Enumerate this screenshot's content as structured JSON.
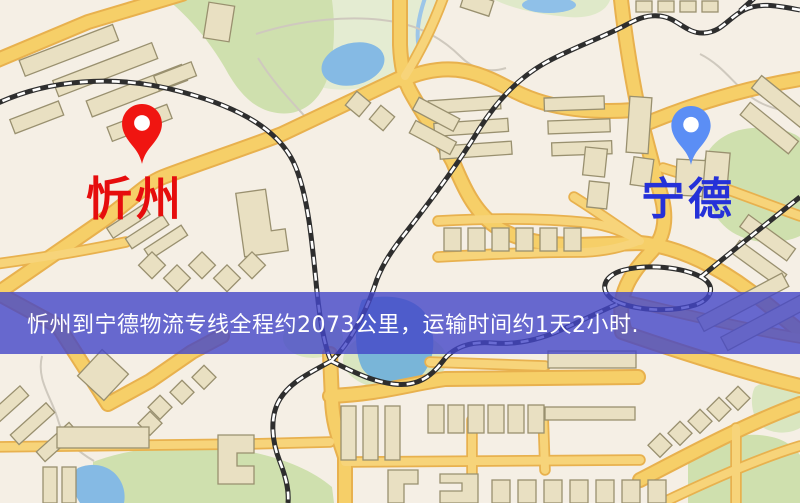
{
  "map": {
    "markers": {
      "origin": {
        "name": "忻州",
        "pin_color": "#f01511",
        "label_color": "#e60d0d"
      },
      "destination": {
        "name": "宁德",
        "pin_color": "#5b8ef5",
        "label_color": "#2531d8"
      }
    },
    "banner": {
      "text": "忻州到宁德物流专线全程约2073公里，运输时间约1天2小时.",
      "background": "rgba(68,70,200,0.80)",
      "text_color": "#ffffff"
    },
    "palette": {
      "background": "#f5efe5",
      "road_core": "#f6cf68",
      "road_casing": "#e8b14e",
      "park": "#cfe0ae",
      "park_pale": "#e4ecd2",
      "water": "#7fb4e0",
      "building_fill": "#e9e0c2",
      "building_stroke": "#99906f",
      "railway": "#2e2e2e",
      "footpath": "#cfc9be"
    }
  }
}
